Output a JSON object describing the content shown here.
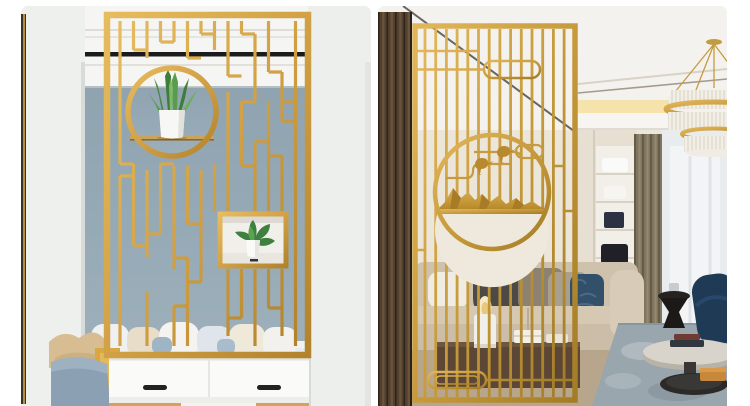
{
  "page": {
    "background": "#ffffff",
    "description": "Two interior product photos of golden stainless-steel room divider screens"
  },
  "photos": {
    "left": {
      "label": "Gold lattice room-divider screen with round planter opening and shadow box, set in a white doorway of a bedroom with grey-blue wall, bed pillows and white drawer cabinet",
      "palette": {
        "gold": "#d2a145",
        "gold_dark": "#b2832c",
        "wall_blue_grey": "#93a7b3",
        "beam_white": "#f5f5f3",
        "black_rail": "#1b1b1b",
        "cabinet_white": "#fafaf9",
        "handle_black": "#222222",
        "base_tan": "#d4a258",
        "pillow_beige": "#d8bd92",
        "chair_yellow": "#d9a845",
        "sofa_blue_grey": "#8ba1b3",
        "plant_green": "#4e9347",
        "pot_white": "#f7f7f5"
      }
    },
    "right": {
      "label": "Gold vertical-bar room-divider screen with round medallion of birds, cloud scrolls and gold mountains, in a living room with wood slat wall, crystal chandelier, curtains, beige sofa and coffee tables",
      "palette": {
        "gold": "#c79b3c",
        "gold_light": "#e2b75c",
        "wall_cream": "#ece6da",
        "ceiling_white": "#f4f2ee",
        "cove_light": "#f6e3ab",
        "wood_slat": "#53412f",
        "curtain_taupe": "#80765f",
        "sheer_white": "#eef1f2",
        "sofa_beige": "#cfc2ad",
        "pillow_blue": "#33506b",
        "rug_blue_grey": "#9aa6ae",
        "armchair_navy": "#1e3a54",
        "tray_amber": "#c8883c",
        "table_black": "#26221f",
        "console_walnut": "#5c4737"
      }
    }
  }
}
